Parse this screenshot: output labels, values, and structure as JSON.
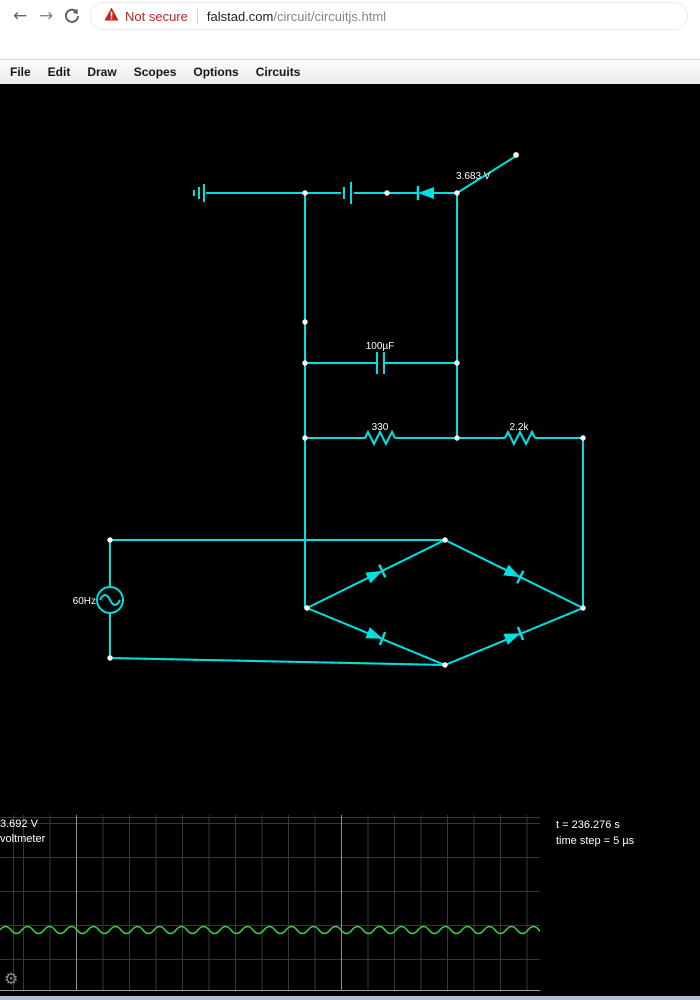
{
  "browser": {
    "back_glyph": "←",
    "forward_glyph": "→",
    "security_warning": "Not secure",
    "url_host": "falstad.com",
    "url_path": "/circuit/circuitjs.html"
  },
  "menu": {
    "items": [
      {
        "label": "File"
      },
      {
        "label": "Edit"
      },
      {
        "label": "Draw"
      },
      {
        "label": "Scopes"
      },
      {
        "label": "Options"
      },
      {
        "label": "Circuits"
      }
    ]
  },
  "circuit": {
    "labels": {
      "switch_voltage": "3.683 V",
      "filter_capacitor": "100µF",
      "resistor_330": "330",
      "resistor_2_2k": "2.2k",
      "ac_source_freq": "60Hz"
    },
    "colors": {
      "wire": "#00e0e0",
      "current_dots": "#e0e04e",
      "posts": "#ffffff",
      "labels": "#ffffff"
    }
  },
  "scope": {
    "voltage_readout": "3.692 V",
    "channel_label": "voltmeter",
    "sim_time": "t = 236.276 s",
    "time_step": "time step = 5 µs",
    "gear_glyph": "⚙",
    "trace_color": "#3ecb3e",
    "grid_color": "#383838",
    "waveform": {
      "type": "dc-with-ripple",
      "period_px": 22,
      "amplitude_px": 3.5,
      "center_px": 115,
      "width_px": 540
    }
  }
}
